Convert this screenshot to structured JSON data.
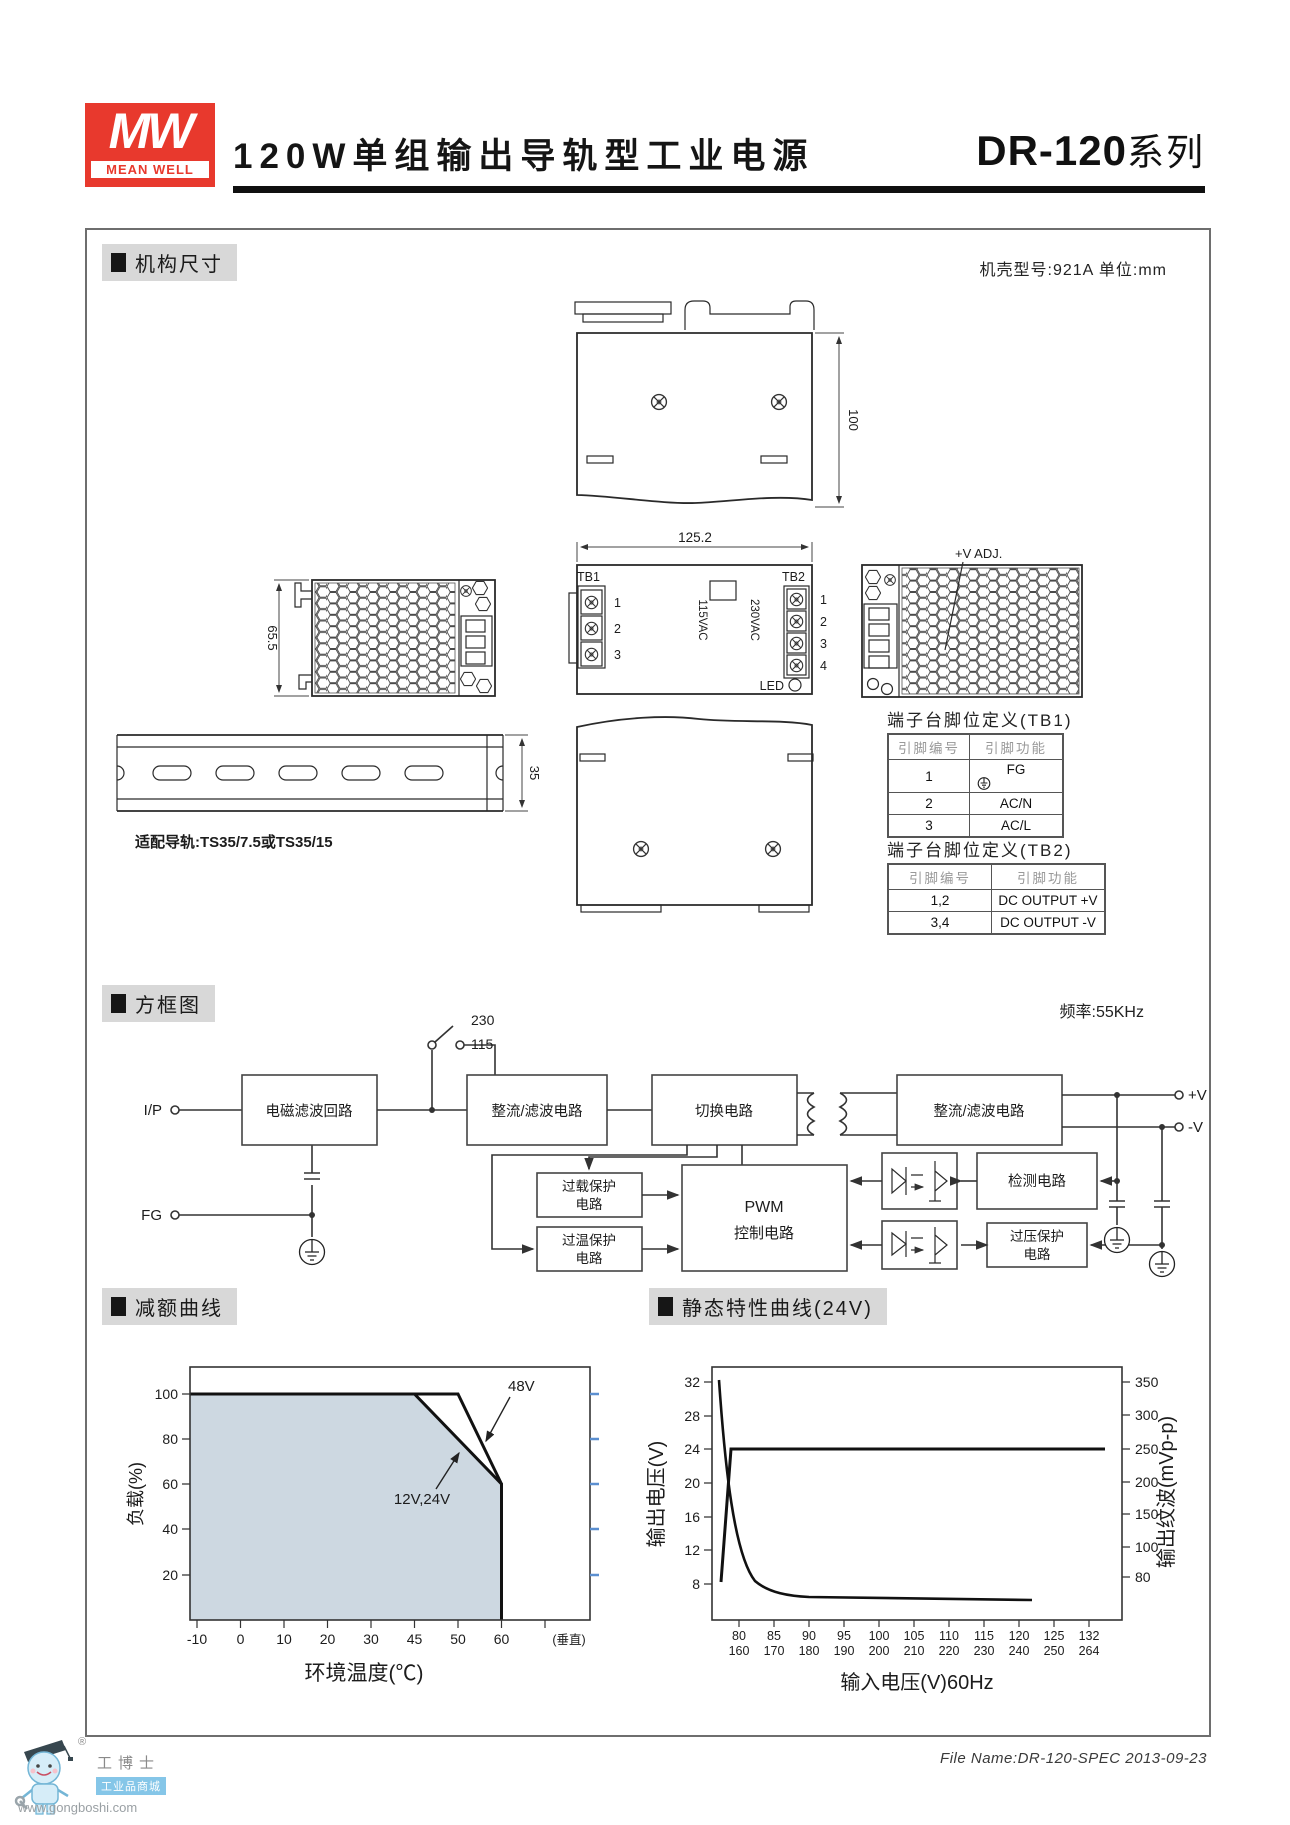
{
  "header": {
    "logo": {
      "mw": "MW",
      "mean_well": "MEAN WELL"
    },
    "title": "120W单组输出导轨型工业电源",
    "series": "DR-120",
    "series_suffix": "系列"
  },
  "mech": {
    "section_title": "机构尺寸",
    "case_note": "机壳型号:921A 单位:mm",
    "dim_height": "100",
    "dim_width": "125.2",
    "dim_depth": "65.5",
    "dim_rail": "35",
    "tb1_label": "TB1",
    "tb2_label": "TB2",
    "vac115": "115VAC",
    "vac230": "230VAC",
    "led_label": "LED",
    "vadj_label": "+V ADJ.",
    "rail_note": "适配导轨:TS35/7.5或TS35/15",
    "tb1_pins": [
      "1",
      "2",
      "3"
    ],
    "tb2_pins": [
      "1",
      "2",
      "3",
      "4"
    ],
    "tb1_table": {
      "title": "端子台脚位定义(TB1)",
      "col1": "引脚编号",
      "col2": "引脚功能",
      "rows": [
        {
          "pin": "1",
          "fn": "FG"
        },
        {
          "pin": "2",
          "fn": "AC/N"
        },
        {
          "pin": "3",
          "fn": "AC/L"
        }
      ]
    },
    "tb2_table": {
      "title": "端子台脚位定义(TB2)",
      "col1": "引脚编号",
      "col2": "引脚功能",
      "rows": [
        {
          "pin": "1,2",
          "fn": "DC OUTPUT +V"
        },
        {
          "pin": "3,4",
          "fn": "DC OUTPUT -V"
        }
      ]
    }
  },
  "block": {
    "section_title": "方框图",
    "freq_note": "频率:55KHz",
    "ip": "I/P",
    "fg": "FG",
    "sw_230": "230",
    "sw_115": "115",
    "emi": "电磁滤波回路",
    "rectifier1": "整流/滤波电路",
    "switching": "切换电路",
    "rectifier2": "整流/滤波电路",
    "overload_1": "过载保护",
    "overload_2": "电路",
    "overtemp_1": "过温保护",
    "overtemp_2": "电路",
    "pwm_1": "PWM",
    "pwm_2": "控制电路",
    "detect": "检测电路",
    "ovp_1": "过压保护",
    "ovp_2": "电路",
    "out_pos": "+V",
    "out_neg": "-V"
  },
  "derating": {
    "section_title": "减额曲线",
    "y_ticks": [
      "100",
      "80",
      "60",
      "40",
      "20"
    ],
    "x_ticks": [
      "-10",
      "0",
      "10",
      "20",
      "30",
      "45",
      "50",
      "60"
    ],
    "x_end": "(垂直)",
    "label_48": "48V",
    "label_1224": "12V,24V",
    "y_axis": "负载(%)",
    "x_axis": "环境温度(℃)"
  },
  "static_curve": {
    "section_title": "静态特性曲线(24V)",
    "left_ticks": [
      "32",
      "28",
      "24",
      "20",
      "16",
      "12",
      "8"
    ],
    "right_ticks": [
      "350",
      "300",
      "250",
      "200",
      "150",
      "100",
      "80"
    ],
    "x_top": [
      "80",
      "85",
      "90",
      "95",
      "100",
      "105",
      "110",
      "115",
      "120",
      "125",
      "132"
    ],
    "x_bottom": [
      "160",
      "170",
      "180",
      "190",
      "200",
      "210",
      "220",
      "230",
      "240",
      "250",
      "264"
    ],
    "left_axis": "输出电压(V)",
    "right_axis": "输出纹波(mVp-p)",
    "x_axis": "输入电压(V)60Hz"
  },
  "footer": {
    "file_note": "File Name:DR-120-SPEC  2013-09-23",
    "mascot_name": "工博士",
    "mascot_sub": "工业品商城",
    "mascot_url": "www.gongboshi.com",
    "reg": "®"
  },
  "colors": {
    "brand_red": "#E8392D",
    "derating_fill": "#CDD8E1",
    "blue_tick": "#5B8FD0",
    "section_bg": "#D8D8D8"
  },
  "chart_data": [
    {
      "type": "area",
      "title": "减额曲线",
      "xlabel": "环境温度(℃)",
      "ylabel": "负载(%)",
      "xlim": [
        -10,
        70
      ],
      "ylim": [
        0,
        110
      ],
      "x_ticks": [
        -10,
        0,
        10,
        20,
        30,
        45,
        50,
        60
      ],
      "x_note": "(垂直)",
      "series": [
        {
          "name": "12V,24V",
          "x": [
            -10,
            45,
            60,
            60
          ],
          "y": [
            100,
            100,
            60,
            0
          ]
        },
        {
          "name": "48V",
          "x": [
            -10,
            50,
            60
          ],
          "y": [
            100,
            100,
            60
          ]
        }
      ],
      "legend_position": "inline-arrows",
      "grid": false
    },
    {
      "type": "line",
      "title": "静态特性曲线(24V)",
      "xlabel": "输入电压(V)60Hz",
      "ylabel_left": "输出电压(V)",
      "ylabel_right": "输出纹波(mVp-p)",
      "left_ticks": [
        32,
        28,
        24,
        20,
        16,
        12,
        8
      ],
      "right_ticks": [
        350,
        300,
        250,
        200,
        150,
        100,
        80
      ],
      "x_ticks_115": [
        80,
        85,
        90,
        95,
        100,
        105,
        110,
        115,
        120,
        125,
        132
      ],
      "x_ticks_230": [
        160,
        170,
        180,
        190,
        200,
        210,
        220,
        230,
        240,
        250,
        264
      ],
      "series": [
        {
          "name": "输出电压(V)",
          "axis": "left",
          "x": [
            78,
            80,
            264
          ],
          "y": [
            8.6,
            24,
            24
          ]
        },
        {
          "name": "输出纹波(mVp-p)",
          "axis": "right",
          "x": [
            79,
            81,
            84,
            88,
            120,
            245
          ],
          "y": [
            350,
            220,
            110,
            78,
            73,
            70
          ]
        }
      ],
      "grid": false
    }
  ]
}
